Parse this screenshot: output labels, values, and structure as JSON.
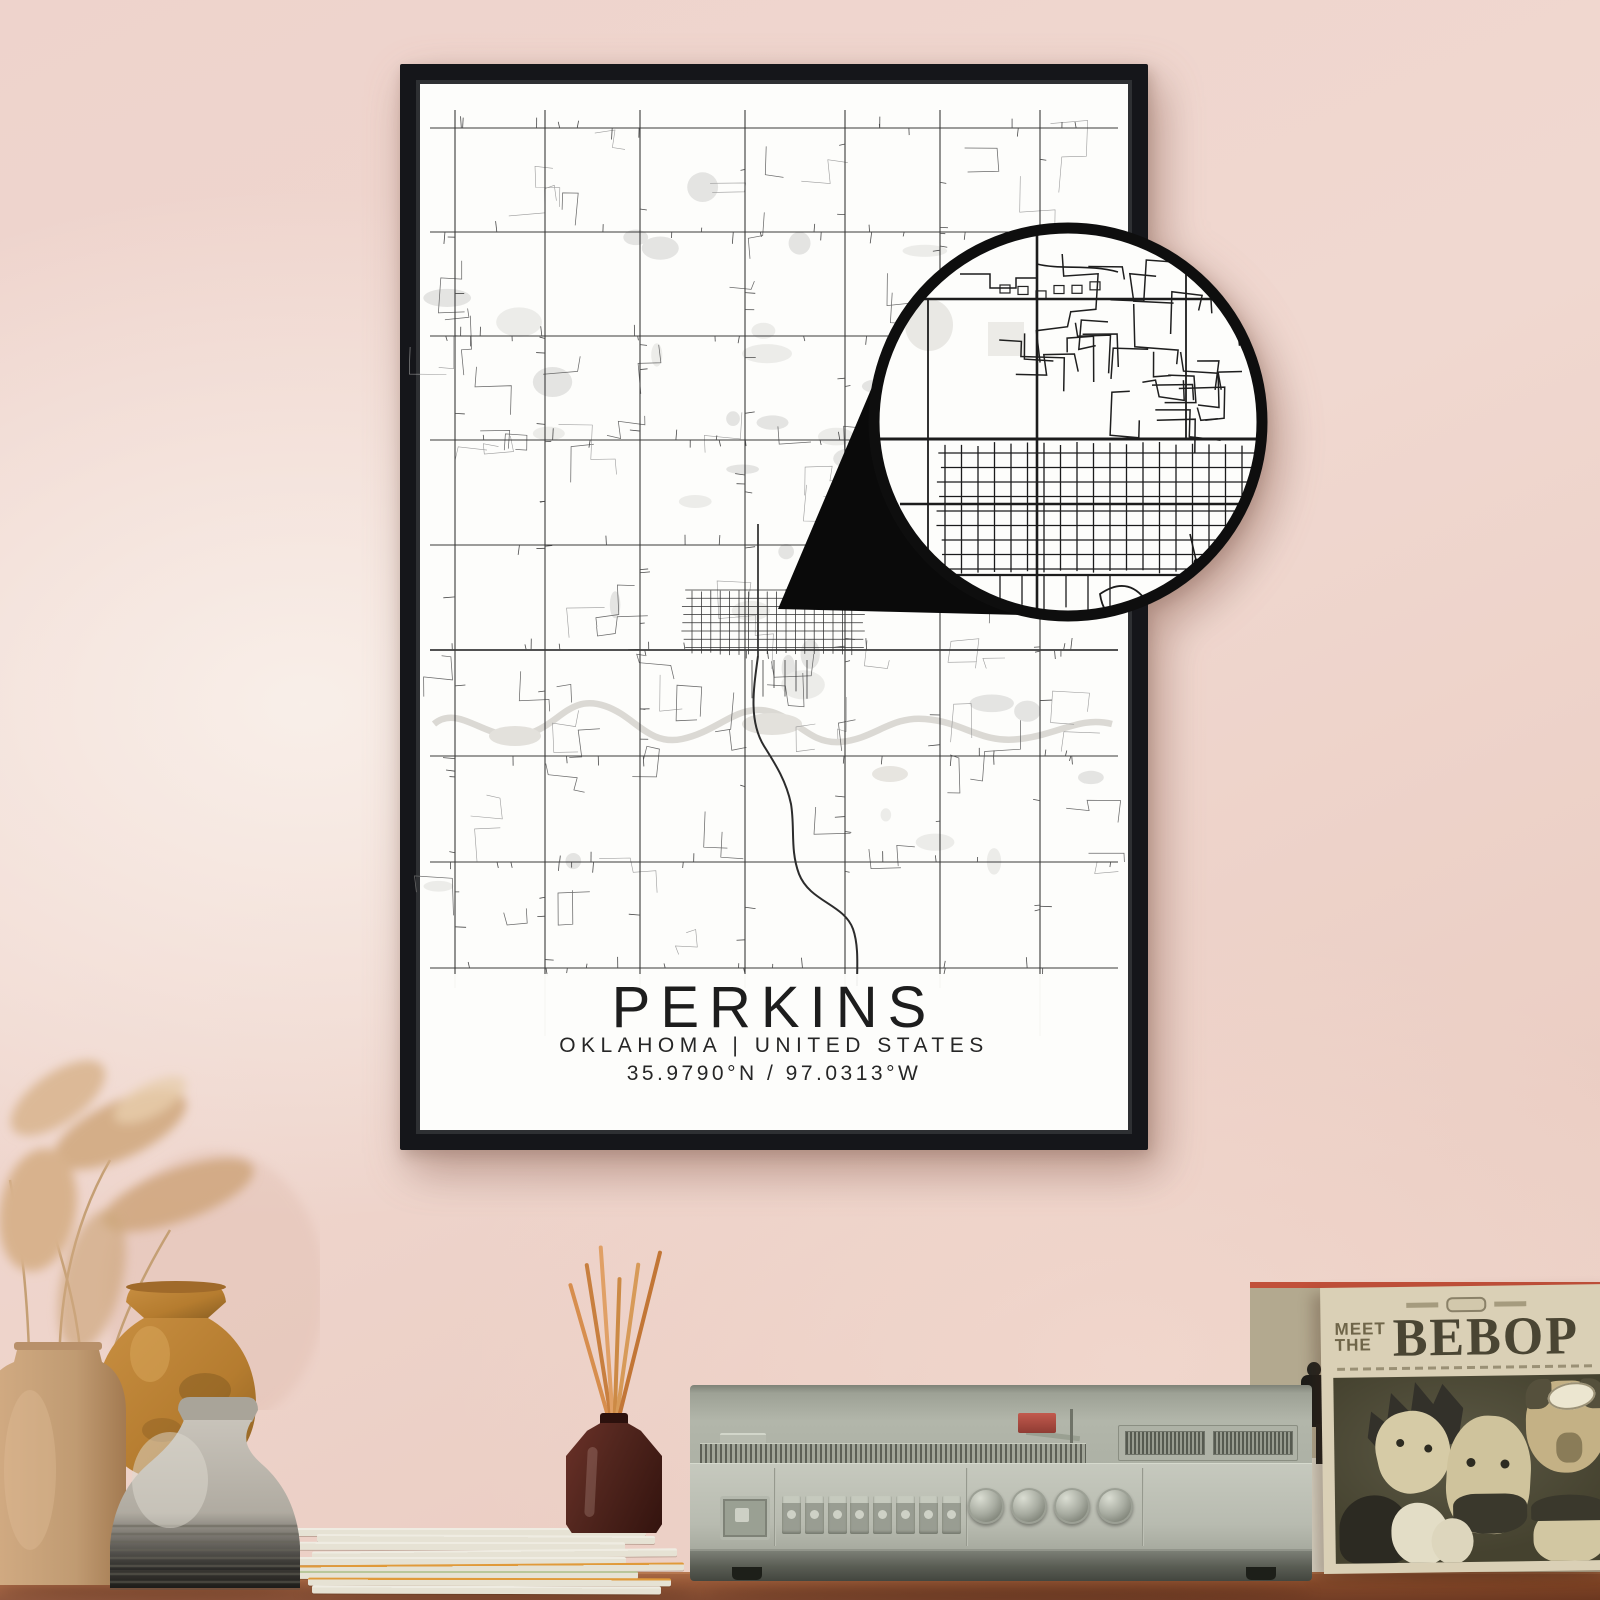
{
  "poster": {
    "title": "PERKINS",
    "subtitle": "OKLAHOMA | UNITED STATES",
    "coordinates": "35.9790°N / 97.0313°W",
    "frame_color": "#15161a",
    "paper_color": "#fdfdfb",
    "road_color": "#3a3a3a",
    "water_color": "#dbd9d4"
  },
  "loupe": {
    "ring_color": "#0e0e0e",
    "pointer_color": "#0a0a0a",
    "fill_color": "#fdfdfb"
  },
  "record_sleeve": {
    "title_line1": "MEET",
    "title_line2": "THE",
    "title_main": "BEBOP",
    "cover_color": "#dad0b6",
    "photo_color": "#4c4936"
  },
  "room": {
    "wall_color": "#efd4cb",
    "table_color": "#9c5733",
    "radio_color": "#b7bab0",
    "vase_colors": [
      "#c9a37b",
      "#bb7f33",
      "#b3aea4"
    ],
    "diffuser_color": "#4e241d",
    "reed_color": "#d28a4c"
  }
}
